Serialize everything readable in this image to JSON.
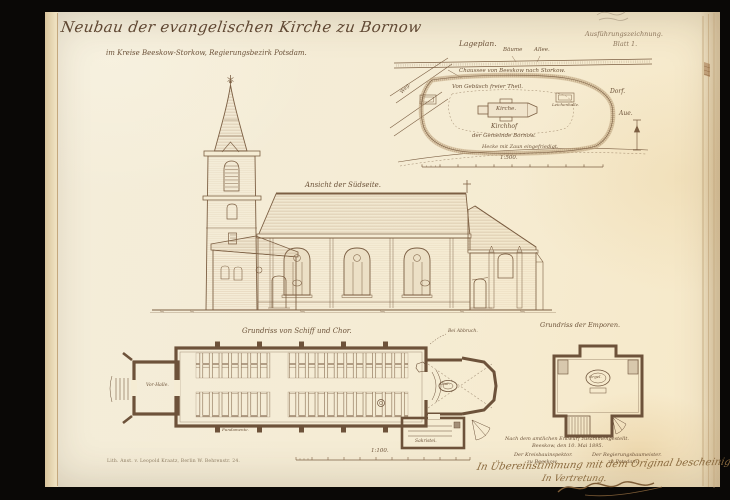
{
  "sheet": {
    "title": "Neubau der evangelischen Kirche zu Bornow",
    "subtitle": "im Kreise Beeskow-Storkow, Regierungsbezirk Potsdam.",
    "series_note": "Ausführungszeichnung.",
    "sheet_number": "Blatt 1.",
    "imprint": "Lith. Anst. v. Leopold Kraatz, Berlin W. Behrenstr. 24."
  },
  "site_plan": {
    "title": "Lageplan.",
    "scale_label": "1:500.",
    "labels": {
      "trees": "Bäume",
      "avenue": "Allee.",
      "road": "Chaussee von Beeskow nach Storkow.",
      "clear_area": "Von Gebüsch freier Theil.",
      "church": "Kirche.",
      "churchyard": "Kirchhof",
      "parish": "der Gemeinde Bornow.",
      "hedge": "Hecke mit Zaun eingefriedigt.",
      "village": "Dorf.",
      "meadow": "Aue.",
      "morgue": "Leichenhalle.",
      "path": "Weg."
    }
  },
  "elevation": {
    "title": "Ansicht der Südseite."
  },
  "nave_plan": {
    "title": "Grundriss von Schiff und Chor.",
    "labels": {
      "porch": "Vor-Halle.",
      "altar": "Altar.",
      "sacristy": "Sakristei.",
      "note": "Bei Abbruch.",
      "foundation": "Fundamente."
    }
  },
  "gallery_plan": {
    "title": "Grundriss der Emporen.",
    "labels": {
      "organ": "Orgel."
    }
  },
  "main_scale": {
    "label": "1:100."
  },
  "approval": {
    "line1": "Nach dem amtlichen Entwurf zusammengestellt.",
    "line2": "Beeskow, den 10. Mai 1895.",
    "left_role": "Der Kreisbauinspektor.",
    "left_place": "zu Beeskow.",
    "right_role": "Der Regierungsbaumeister.",
    "right_place": "zu Potsdam.",
    "certify_line": "In Übereinstimmung mit dem Original bescheinigt.",
    "deputy_line": "In Vertretung."
  },
  "colors": {
    "paper": "#f5ecd4",
    "ink": "#7c5f43",
    "hand_ink": "#8a6a3e",
    "frame": "#0a0806"
  }
}
